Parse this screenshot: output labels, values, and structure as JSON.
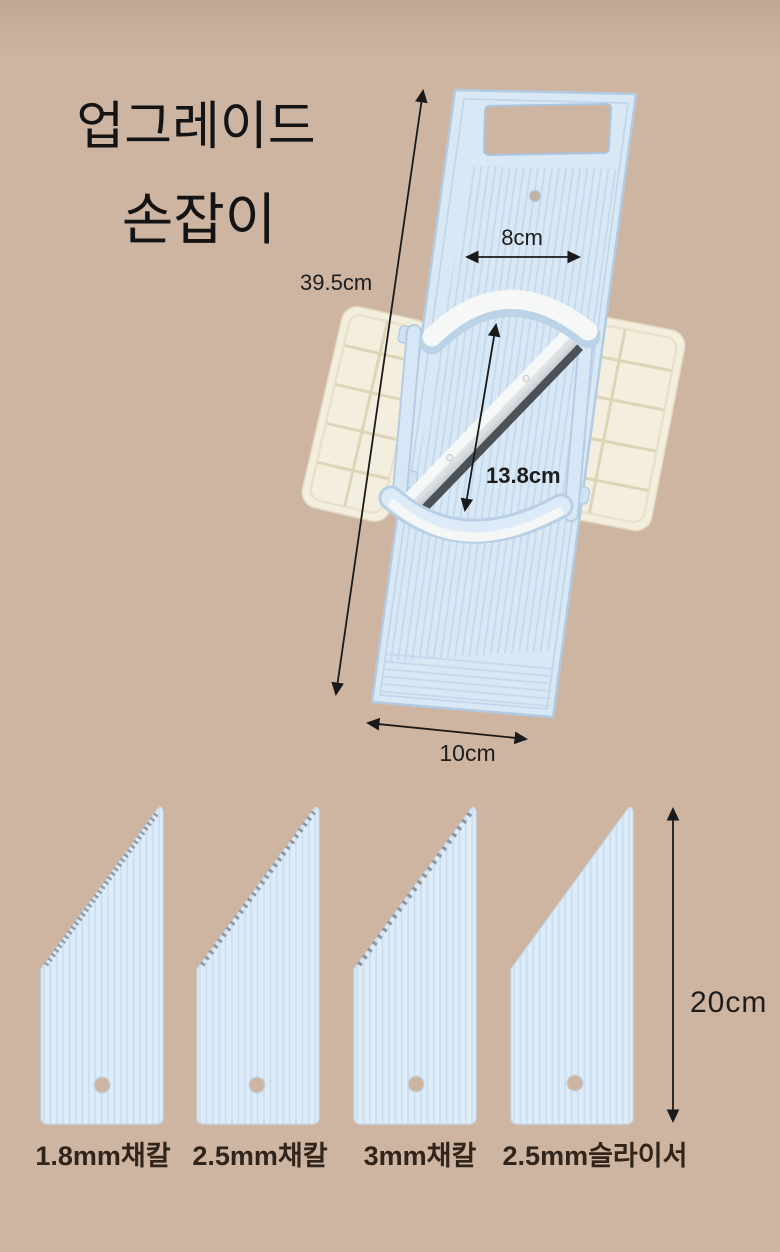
{
  "header": {
    "title_line1": "업그레이드",
    "title_line2": "손잡이"
  },
  "slicer": {
    "length_label": "39.5cm",
    "top_width_label": "8cm",
    "blade_diagonal_label": "13.8cm",
    "bottom_width_label": "10cm"
  },
  "inserts": {
    "height_label": "20cm",
    "items": [
      {
        "label": "1.8mm채칼"
      },
      {
        "label": "2.5mm채칼"
      },
      {
        "label": "3mm채칼"
      },
      {
        "label": "2.5mm슬라이서"
      }
    ]
  },
  "colors": {
    "background": "#cdb5a1",
    "product_blue": "#d9e8f5",
    "product_blue_edge": "#b2cbe3",
    "wing_cream": "#f3eedd",
    "steel_dark": "#4b5157",
    "annotation_text": "#1d1d1d",
    "insert_label_text": "#31241a"
  }
}
